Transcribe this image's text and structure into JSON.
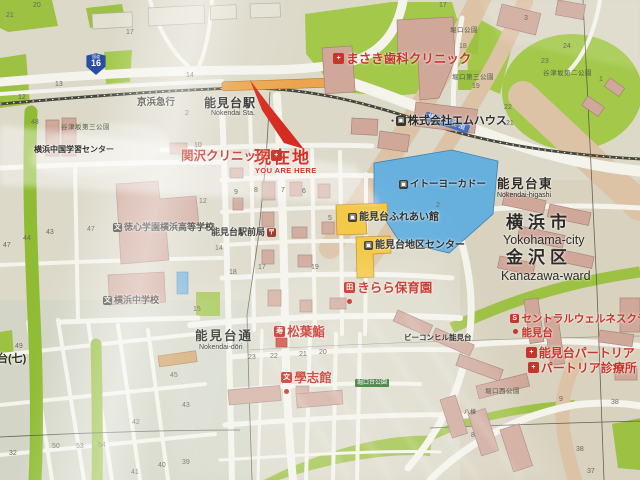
{
  "map": {
    "railway_operator": "京浜急行",
    "station": {
      "name": "能見台駅",
      "romaji": "Nokendai Sta."
    },
    "current_location": {
      "jp": "現在地",
      "en": "YOU ARE HERE"
    },
    "route_shield": {
      "type": "国道",
      "number": "16"
    },
    "road_banner": "横須賀街道",
    "region": {
      "district_east": {
        "jp": "能見台東",
        "romaji": "Nokendai-higashi"
      },
      "city": {
        "jp": "横浜市",
        "en": "Yokohama-city"
      },
      "ward": {
        "jp": "金沢区",
        "en": "Kanazawa-ward"
      },
      "street": {
        "jp": "能見台通",
        "romaji": "Nokendai-dōri"
      },
      "area_edge_label": "台(七)"
    },
    "icon_glyphs": {
      "clinic": "+",
      "company": "▣",
      "post": "〒",
      "store": "▣",
      "public": "▣",
      "nursery": "田",
      "sushi": "寿",
      "juku": "文",
      "gym": "S",
      "hospital": "+",
      "school": "文"
    },
    "pois": [
      {
        "id": "masaki-dental-clinic",
        "name": "まさき歯科クリニック",
        "icon": "clinic",
        "color": "red",
        "x": 333,
        "y": 53,
        "fs": 12.5
      },
      {
        "id": "mhouse-company",
        "name": "株式会社エムハウス",
        "icon": "company",
        "color": "dark",
        "x": 391,
        "y": 116,
        "fs": 11,
        "bullet": true
      },
      {
        "id": "sekizawa-clinic",
        "name": "関沢クリニック",
        "icon": "clinic",
        "color": "red",
        "x": 181,
        "y": 150,
        "fs": 12.5,
        "icon_side": "right"
      },
      {
        "id": "nokendai-ekimae-post-office",
        "name": "能見台駅前局",
        "icon": "post",
        "color": "dark",
        "x": 211,
        "y": 228,
        "fs": 9,
        "icon_side": "right"
      },
      {
        "id": "ito-yokado",
        "name": "イトーヨーカドー",
        "icon": "store",
        "color": "dark",
        "x": 399,
        "y": 180,
        "fs": 9.5
      },
      {
        "id": "nokendai-fureaikan",
        "name": "能見台ふれあい館",
        "icon": "public",
        "color": "dark",
        "x": 348,
        "y": 213,
        "fs": 10
      },
      {
        "id": "nokendai-district-center",
        "name": "能見台地区センター",
        "icon": "public",
        "color": "dark",
        "x": 364,
        "y": 241,
        "fs": 10
      },
      {
        "id": "kirara-nursery",
        "name": "きらら保育園",
        "icon": "nursery",
        "color": "red",
        "x": 344,
        "y": 282,
        "fs": 12.5,
        "dot": true
      },
      {
        "id": "beacon-hill-nokendai",
        "name": "ビーコンヒル能見台",
        "color": "dark",
        "x": 404,
        "y": 334,
        "fs": 7.5
      },
      {
        "id": "matsuba-sushi",
        "name": "松葉鮨",
        "icon": "sushi",
        "color": "red",
        "x": 274,
        "y": 326,
        "fs": 12.5
      },
      {
        "id": "gakushikan",
        "name": "學志館",
        "icon": "juku",
        "color": "red",
        "x": 281,
        "y": 372,
        "fs": 12.5,
        "dot": true
      },
      {
        "id": "central-wellness-club-nokendai",
        "name": "セントラルウェルネスクラブ",
        "name2": "能見台",
        "icon": "gym",
        "color": "red",
        "x": 510,
        "y": 314,
        "fs": 10.5,
        "dot": true
      },
      {
        "id": "nokendai-patria",
        "name": "能見台パートリア",
        "icon": "hospital",
        "color": "red",
        "x": 526,
        "y": 347,
        "fs": 12
      },
      {
        "id": "patria-clinic",
        "name": "パートリア診療所",
        "icon": "hospital",
        "color": "red",
        "x": 528,
        "y": 362,
        "fs": 12
      },
      {
        "id": "tokushin-gakuen-yokohama-high-school",
        "name": "徳心学園横浜高等学校",
        "icon": "school",
        "color": "dark",
        "x": 113,
        "y": 223,
        "fs": 9
      },
      {
        "id": "yokohama-junior-high-school",
        "name": "横浜中学校",
        "icon": "school",
        "color": "dark",
        "x": 103,
        "y": 296,
        "fs": 9
      },
      {
        "id": "yokohama-gakushu-center",
        "name": "横浜中国学習センター",
        "color": "dark",
        "x": 34,
        "y": 146,
        "fs": 8
      }
    ],
    "parks": [
      {
        "name": "堀口公園",
        "x": 450,
        "y": 28
      },
      {
        "name": "谷津坂第三公園",
        "x": 61,
        "y": 125
      },
      {
        "name": "堀口第三公園",
        "x": 452,
        "y": 75
      },
      {
        "name": "谷津坂第二公園",
        "x": 543,
        "y": 71
      },
      {
        "name": "堀口西公園",
        "x": 485,
        "y": 389
      },
      {
        "name": "堀口台公園",
        "x": 355,
        "y": 379,
        "banner": true
      }
    ],
    "misc_labels": [
      {
        "text": "八棟",
        "x": 464,
        "y": 410,
        "fs": 6
      }
    ],
    "block_numbers": [
      {
        "n": "20",
        "x": 33,
        "y": 2
      },
      {
        "n": "21",
        "x": 6,
        "y": 12
      },
      {
        "n": "17",
        "x": 126,
        "y": 29
      },
      {
        "n": "13",
        "x": 55,
        "y": 81
      },
      {
        "n": "12",
        "x": 18,
        "y": 94
      },
      {
        "n": "14",
        "x": 186,
        "y": 72
      },
      {
        "n": "2",
        "x": 185,
        "y": 110
      },
      {
        "n": "48",
        "x": 31,
        "y": 119
      },
      {
        "n": "10",
        "x": 194,
        "y": 142
      },
      {
        "n": "17",
        "x": 439,
        "y": 2
      },
      {
        "n": "3",
        "x": 524,
        "y": 15
      },
      {
        "n": "18",
        "x": 459,
        "y": 43
      },
      {
        "n": "24",
        "x": 563,
        "y": 43
      },
      {
        "n": "23",
        "x": 541,
        "y": 58
      },
      {
        "n": "19",
        "x": 472,
        "y": 83
      },
      {
        "n": "22",
        "x": 504,
        "y": 104
      },
      {
        "n": "21",
        "x": 506,
        "y": 120
      },
      {
        "n": "20",
        "x": 449,
        "y": 123
      },
      {
        "n": "1",
        "x": 599,
        "y": 76
      },
      {
        "n": "2",
        "x": 436,
        "y": 202
      },
      {
        "n": "9",
        "x": 234,
        "y": 189
      },
      {
        "n": "8",
        "x": 254,
        "y": 187
      },
      {
        "n": "7",
        "x": 281,
        "y": 187
      },
      {
        "n": "6",
        "x": 302,
        "y": 188
      },
      {
        "n": "5",
        "x": 328,
        "y": 215
      },
      {
        "n": "12",
        "x": 199,
        "y": 198
      },
      {
        "n": "13",
        "x": 207,
        "y": 223
      },
      {
        "n": "14",
        "x": 215,
        "y": 245
      },
      {
        "n": "18",
        "x": 229,
        "y": 269
      },
      {
        "n": "17",
        "x": 258,
        "y": 264
      },
      {
        "n": "19",
        "x": 311,
        "y": 264
      },
      {
        "n": "15",
        "x": 193,
        "y": 306
      },
      {
        "n": "23",
        "x": 248,
        "y": 354
      },
      {
        "n": "22",
        "x": 270,
        "y": 353
      },
      {
        "n": "21",
        "x": 299,
        "y": 351
      },
      {
        "n": "20",
        "x": 319,
        "y": 349
      },
      {
        "n": "45",
        "x": 170,
        "y": 372
      },
      {
        "n": "43",
        "x": 182,
        "y": 402
      },
      {
        "n": "44",
        "x": 23,
        "y": 235
      },
      {
        "n": "43",
        "x": 46,
        "y": 229
      },
      {
        "n": "47",
        "x": 3,
        "y": 242
      },
      {
        "n": "47",
        "x": 87,
        "y": 226
      },
      {
        "n": "42",
        "x": 132,
        "y": 419
      },
      {
        "n": "49",
        "x": 15,
        "y": 343
      },
      {
        "n": "50",
        "x": 52,
        "y": 443
      },
      {
        "n": "53",
        "x": 76,
        "y": 443
      },
      {
        "n": "54",
        "x": 98,
        "y": 442
      },
      {
        "n": "32",
        "x": 9,
        "y": 450
      },
      {
        "n": "41",
        "x": 131,
        "y": 469
      },
      {
        "n": "40",
        "x": 158,
        "y": 462
      },
      {
        "n": "39",
        "x": 182,
        "y": 459
      },
      {
        "n": "9",
        "x": 559,
        "y": 396
      },
      {
        "n": "38",
        "x": 611,
        "y": 399
      },
      {
        "n": "38",
        "x": 576,
        "y": 446
      },
      {
        "n": "37",
        "x": 587,
        "y": 468
      },
      {
        "n": "8",
        "x": 471,
        "y": 432
      }
    ],
    "colors": {
      "park_green": "#a3c84a",
      "building_pink": "#cfa89a",
      "road_white": "#f4f3ec",
      "tan_road": "#dcc3a6",
      "rail_dark": "#45453a",
      "station_orange": "#eca54e",
      "blue_building": "#66b0de",
      "yellow_building": "#f2c63e",
      "poi_red": "#c8342a",
      "banner_blue": "#3f6fc1",
      "shield_blue": "#2a4fa2"
    }
  }
}
